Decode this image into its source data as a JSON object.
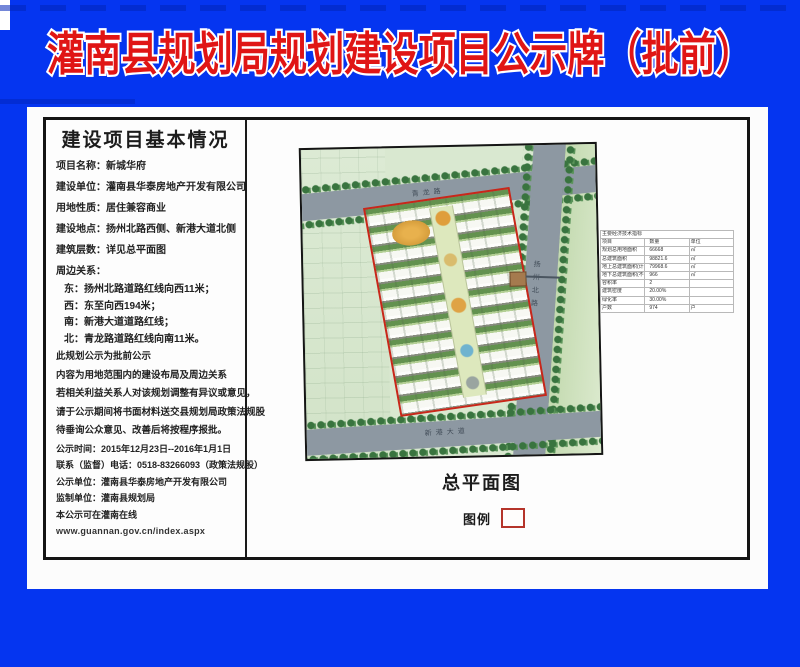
{
  "title": "灌南县规划局规划建设项目公示牌（批前）",
  "doc": {
    "header": "建设项目基本情况",
    "lines": [
      "项目名称：新城华府",
      "建设单位：灌南县华泰房地产开发有限公司",
      "用地性质：居住兼容商业",
      "建设地点：扬州北路西侧、新港大道北侧",
      "建筑层数：详见总平面图",
      "周边关系：",
      "东：扬州北路道路红线向西11米；",
      "西：东至向西194米；",
      "南：新港大道道路红线；",
      "北：青龙路道路红线向南11米。",
      "此规划公示为批前公示",
      "内容为用地范围内的建设布局及周边关系",
      "若相关利益关系人对该规划调整有异议或意见，",
      "请于公示期间将书面材料送交县规划局政策法规股",
      "待垂询公众意见、改善后将按程序报批。",
      "公示时间：2015年12月23日--2016年1月1日",
      "联系（监督）电话：0518-83266093（政策法规股）",
      "公示单位：灌南县华泰房地产开发有限公司",
      "监制单位：灌南县规划局",
      "本公示可在灌南在线",
      "www.guannan.gov.cn/index.aspx"
    ],
    "plan_caption": "总平面图",
    "legend_label": "图例"
  },
  "plan": {
    "road_labels": {
      "top": "青龙路",
      "right": "扬州北路",
      "bottom": "新港大道"
    }
  },
  "table": {
    "title": "主要经济技术指标",
    "headers": [
      "项目",
      "数量",
      "单位"
    ],
    "rows": [
      [
        "规划总用地面积",
        "66668",
        "㎡"
      ],
      [
        "总建筑面积",
        "98821.6",
        "㎡"
      ],
      [
        "地上总建筑面积(计容)",
        "79968.6",
        "㎡"
      ],
      [
        "地下总建筑面积(不计容)",
        "966",
        "㎡"
      ],
      [
        "容积率",
        "2",
        ""
      ],
      [
        "建筑密度",
        "20.00%",
        ""
      ],
      [
        "绿化率",
        "30.00%",
        ""
      ],
      [
        "户数",
        "974",
        "户"
      ]
    ]
  },
  "colors": {
    "board_blue": "#0535f0",
    "title_red": "#e01515",
    "boundary_red": "#c8271a",
    "road_gray": "#8d98a2"
  }
}
